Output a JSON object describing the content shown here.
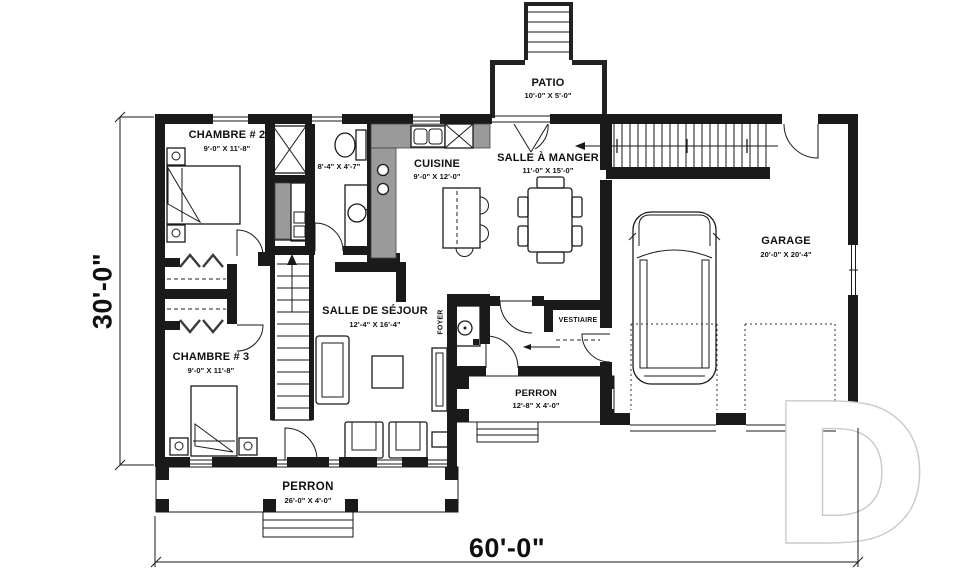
{
  "rooms": {
    "chambre_2": {
      "name": "CHAMBRE # 2",
      "dims": "9'-0\" X 11'-8\""
    },
    "salle_de_bain": {
      "dims": "8'-4\" X 4'-7\""
    },
    "cuisine": {
      "name": "CUISINE",
      "dims": "9'-0\" X 12'-0\""
    },
    "salle_a_manger": {
      "name": "SALLE À MANGER",
      "dims": "11'-0\" X 15'-0\""
    },
    "patio": {
      "name": "PATIO",
      "dims": "10'-0\" X 5'-0\""
    },
    "garage": {
      "name": "GARAGE",
      "dims": "20'-0\" X 20'-4\""
    },
    "salle_de_sejour": {
      "name": "SALLE DE SÉJOUR",
      "dims": "12'-4\" X 16'-4\""
    },
    "chambre_3": {
      "name": "CHAMBRE # 3",
      "dims": "9'-0\" X 11'-8\""
    },
    "foyer": {
      "name": "FOYER"
    },
    "vestiaire": {
      "name": "VESTIAIRE"
    },
    "perron_entree": {
      "name": "PERRON",
      "dims": "12'-8\" X 4'-0\""
    },
    "perron_facade": {
      "name": "PERRON",
      "dims": "26'-0\" X 4'-0\""
    }
  },
  "overall_dimensions": {
    "width": "60'-0\"",
    "depth": "30'-0\""
  },
  "watermark": {
    "letter": "D"
  },
  "colors": {
    "wall": "#1a1a1a",
    "counter": "#9a9a9a",
    "paper": "#ffffff",
    "watermark_stroke": "#c9c9c9"
  }
}
